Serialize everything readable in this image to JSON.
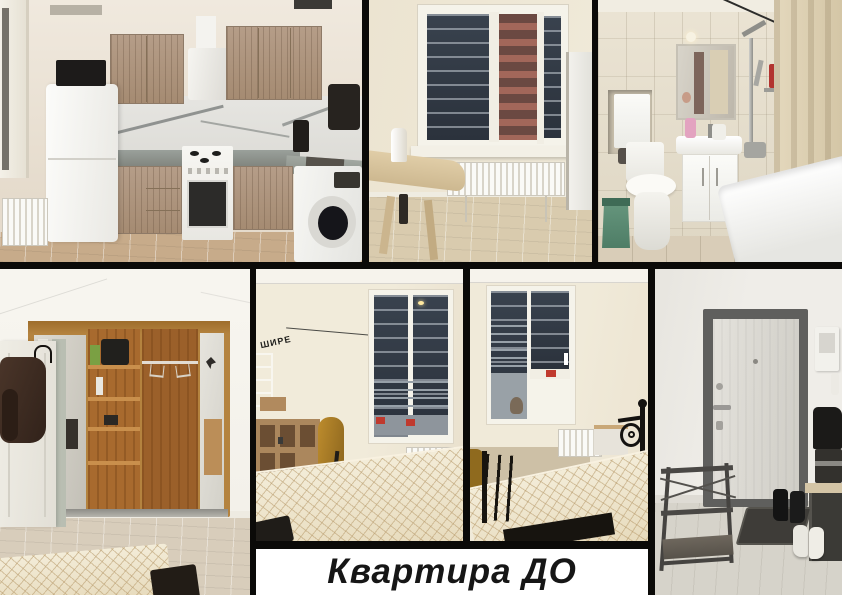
{
  "caption": {
    "text": "Квартира ДО"
  },
  "wall_decal": {
    "text": "ШИРЕ"
  },
  "collage": {
    "gutter_color": "#0b0a08",
    "caption_bg": "#ffffff",
    "caption_text_color": "#161616",
    "photos": [
      {
        "id": "kitchen"
      },
      {
        "id": "dining-window"
      },
      {
        "id": "bathroom"
      },
      {
        "id": "wardrobe"
      },
      {
        "id": "bedroom-1"
      },
      {
        "id": "bedroom-2"
      },
      {
        "id": "entryway"
      }
    ]
  }
}
